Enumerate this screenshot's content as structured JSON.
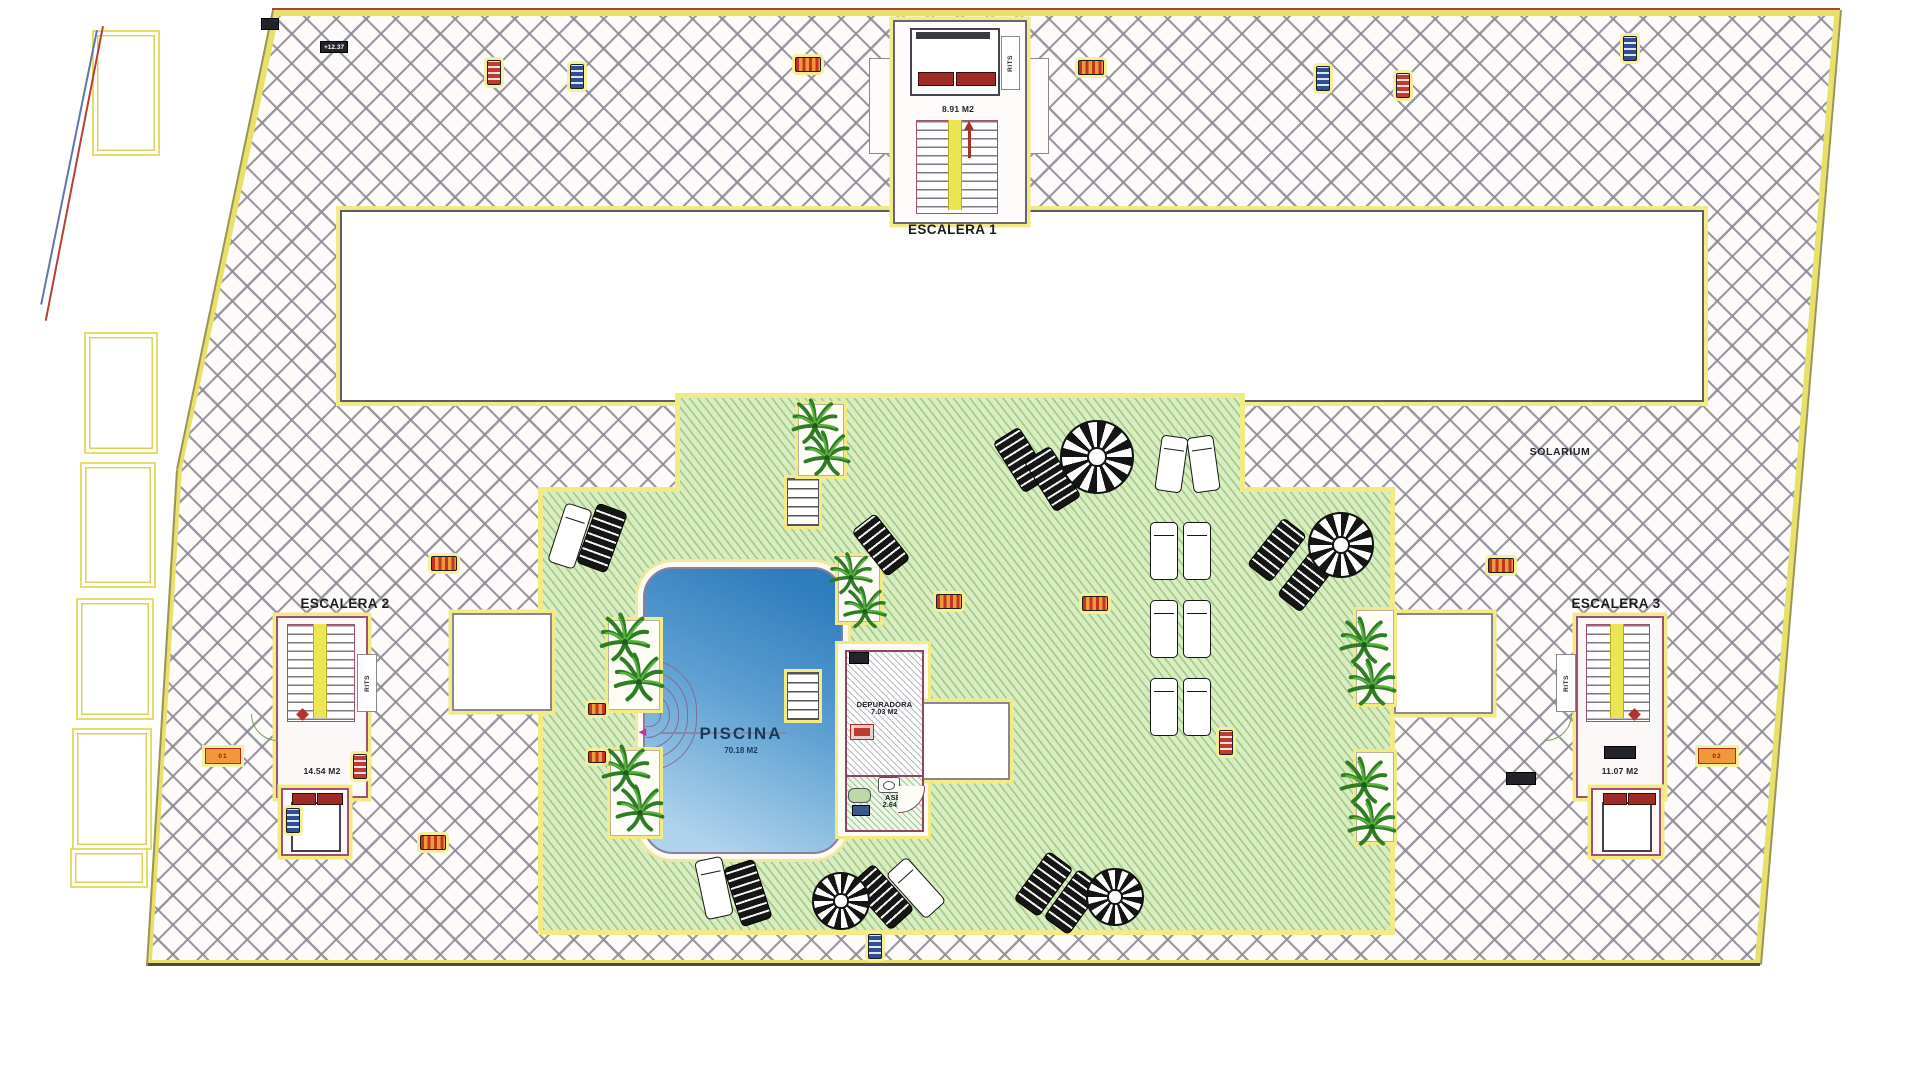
{
  "plan": {
    "escalera1": {
      "label": "ESCALERA 1",
      "area": "8.91 M2",
      "rits": "RITS"
    },
    "escalera2": {
      "label": "ESCALERA 2",
      "area": "14.54 M2",
      "rits": "RITS",
      "tag": "01"
    },
    "escalera3": {
      "label": "ESCALERA 3",
      "area": "11.07 M2",
      "rits": "RITS",
      "tag": "02"
    },
    "piscina": {
      "label": "PISCINA",
      "area": "70.18 M2"
    },
    "depuradora": {
      "label": "DEPURADORA",
      "area": "7.03 M2"
    },
    "aseo": {
      "label": "ASEO",
      "area": "2.64 M2"
    },
    "solarium_label": "SOLARIUM",
    "elevation_marker": "+12.37",
    "colors": {
      "deck_green": "#d9ecc4",
      "deck_green_stripe": "#76b44e",
      "pool_deep": "#2d7cbd",
      "pool_shallow": "#aed3ec",
      "hatch_line": "#8c8794",
      "yellow_trim": "#f2eb85",
      "wall_pink": "#a0516b",
      "marker_red": "#c03a2e",
      "marker_blue": "#2e4f94",
      "marker_orange": "#ef9a3a",
      "door_red": "#9e2b25"
    }
  }
}
